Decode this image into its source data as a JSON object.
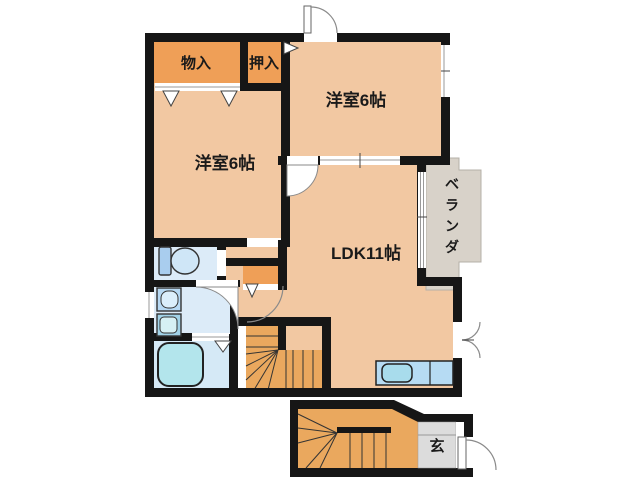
{
  "rooms": {
    "storage": {
      "label": "物入"
    },
    "closet": {
      "label": "押入"
    },
    "bedroom_top": {
      "label": "洋室6帖"
    },
    "bedroom_left": {
      "label": "洋室6帖"
    },
    "ldk": {
      "label": "LDK11帖"
    },
    "veranda": {
      "label": "ベランダ",
      "chars": [
        "ベ",
        "ラ",
        "ン",
        "ダ"
      ]
    },
    "entrance": {
      "label": "玄"
    }
  },
  "colors": {
    "background": "#ffffff",
    "wall": "#161616",
    "room_peach": "#f2c8a2",
    "closet_orange": "#ef9f57",
    "stairs_orange": "#eaa85e",
    "water_blue": "#dcebf8",
    "bathtub_aqua": "#b3e5ec",
    "veranda_gray": "#d8d2c9",
    "entrance_gray": "#dcdcdc",
    "kitchen_counter_blue": "#b6dbf3"
  }
}
